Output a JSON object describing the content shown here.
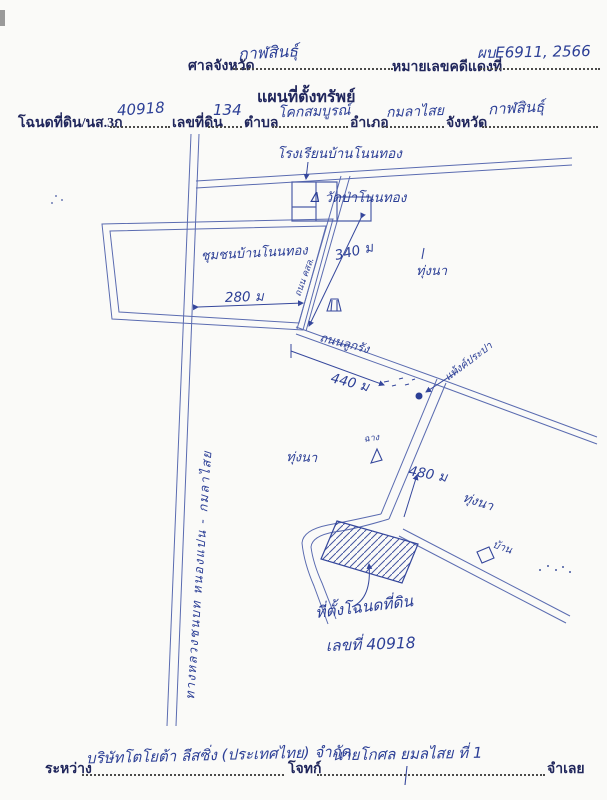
{
  "paper": {
    "bg": "#fafaf8",
    "ink_hand": "#2c3f96",
    "ink_line": "#5a6bb0",
    "ink_printed": "#20265c"
  },
  "header": {
    "court_label": "ศาลจังหวัด",
    "court_value": "กาฬสินธุ์",
    "case_label": "หมายเลขคดีแดงที่",
    "case_value": "ผบE6911, 2566",
    "title": "แผนที่ตั้งทรัพย์",
    "deed_label": "โฉนดที่ดิน/นส.3ก",
    "deed_value": "40918",
    "parcel_label": "เลขที่ดิน",
    "parcel_value": "134",
    "tambon_label": "ตำบล",
    "tambon_value": "โคกสมบูรณ์",
    "amphoe_label": "อำเภอ",
    "amphoe_value": "กมลาไสย",
    "province_label": "จังหวัด",
    "province_value": "กาฬสินธุ์"
  },
  "map": {
    "school_label": "โรงเรียนบ้านโนนทอง",
    "temple_label": "Δ วัดป่าโนนทอง",
    "village_label": "ชุมชนบ้านโนนทอง",
    "dist_280": "280 ม",
    "dist_340": "340 ม",
    "dist_440": "440 ม",
    "dist_480": "480 ม",
    "field_label_1": "ทุ่งนา",
    "field_label_2": "ทุ่งนา",
    "field_label_3": "ทุ่งนา",
    "gravel_road_label": "ถนนลูกรัง",
    "concrete_road_label": "ถนน คสล.",
    "tank_label": "แท้งค์ประปา",
    "barn_label": "ฉาง",
    "house_label": "บ้าน",
    "highway_label": "ทางหลวงชนบท หนองแปน - กมลาไสย",
    "site_label_1": "ที่ตั้งโฉนดที่ดิน",
    "site_label_2": "เลขที่ 40918",
    "symbols": {
      "hut": "hut-icon",
      "barn_triangle": "triangle-icon",
      "house_square": "square-icon",
      "tank_dot": "dot-icon"
    }
  },
  "footer": {
    "between_label": "ระหว่าง",
    "plaintiff_value": "บริษัทโตโยต้า ลีสซิ่ง (ประเทศไทย) จำกัด",
    "plaintiff_label": "โจทก์",
    "defendant_value": "นายโกศล ยมลไสย ที่ 1",
    "defendant_label": "จำเลย"
  }
}
